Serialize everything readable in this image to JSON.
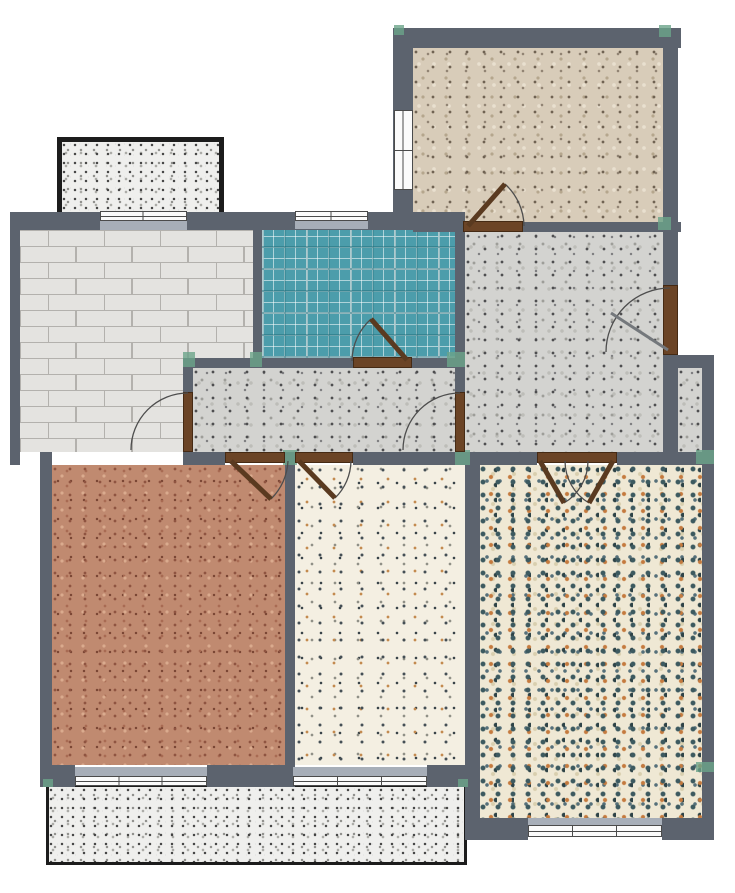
{
  "title": "Apartment floor plan",
  "palette": {
    "wall": "#5c636e",
    "window_sill": "#a7aeb8",
    "window_frame": "#fbfbfb",
    "door_brown": "#6b4426",
    "tile_teal": "#4c9dab",
    "brick_floor": "#e4e3e0",
    "accent_green": "#6ba489",
    "balcony_border": "#1c1c1c",
    "background": "#ffffff"
  },
  "rooms": [
    {
      "id": "balcony-top",
      "label": "Enclosed balcony (top-left), gray grit floor"
    },
    {
      "id": "room-brick",
      "label": "Room with light-gray brick floor (upper-left)"
    },
    {
      "id": "bathroom",
      "label": "Bathroom with teal plaid tile floor"
    },
    {
      "id": "bedroom-top-right",
      "label": "Bedroom with tan granite-speckle floor (top-right)"
    },
    {
      "id": "living-room",
      "label": "Living area with gray terrazzo floor (center-right)"
    },
    {
      "id": "hallway",
      "label": "Hallway with gray terrazzo floor (center)"
    },
    {
      "id": "duct-nook",
      "label": "Small utility shaft (right side)"
    },
    {
      "id": "bedroom-salmon",
      "label": "Bedroom with salmon terrazzo floor (bottom-left)"
    },
    {
      "id": "room-cream",
      "label": "Room with cream multicolor terrazzo floor (bottom-center)"
    },
    {
      "id": "room-confetti",
      "label": "Room with dense teal-orange confetti terrazzo (bottom-right)"
    },
    {
      "id": "balcony-bottom",
      "label": "Long balcony with grit floor (bottom)"
    }
  ],
  "doors": [
    {
      "id": "entry-door",
      "label": "Entry door on right exterior wall"
    },
    {
      "id": "bathroom-door",
      "label": "Bathroom door to hallway"
    },
    {
      "id": "bedroom-door",
      "label": "Top-right bedroom door"
    },
    {
      "id": "brick-room-door",
      "label": "Door between brick-floor room and hallway"
    },
    {
      "id": "hall-living-door",
      "label": "Door between hallway and living area"
    },
    {
      "id": "salmon-bedroom-door",
      "label": "Door to salmon bedroom"
    },
    {
      "id": "cream-room-door",
      "label": "Door to cream-floor room"
    },
    {
      "id": "double-door",
      "label": "Double door between living area and bottom-right room"
    }
  ],
  "windows": [
    {
      "id": "window-brick-top",
      "label": "Window on top wall of brick-floor room"
    },
    {
      "id": "window-bathroom",
      "label": "Bathroom window (top wall)"
    },
    {
      "id": "window-bedroom-left",
      "label": "Window on left wall of top-right bedroom"
    },
    {
      "id": "window-salmon-bottom",
      "label": "Window from salmon bedroom to balcony"
    },
    {
      "id": "window-cream-bottom",
      "label": "Window from cream room to balcony"
    },
    {
      "id": "window-confetti-bottom",
      "label": "Window on bottom wall of bottom-right room"
    }
  ]
}
